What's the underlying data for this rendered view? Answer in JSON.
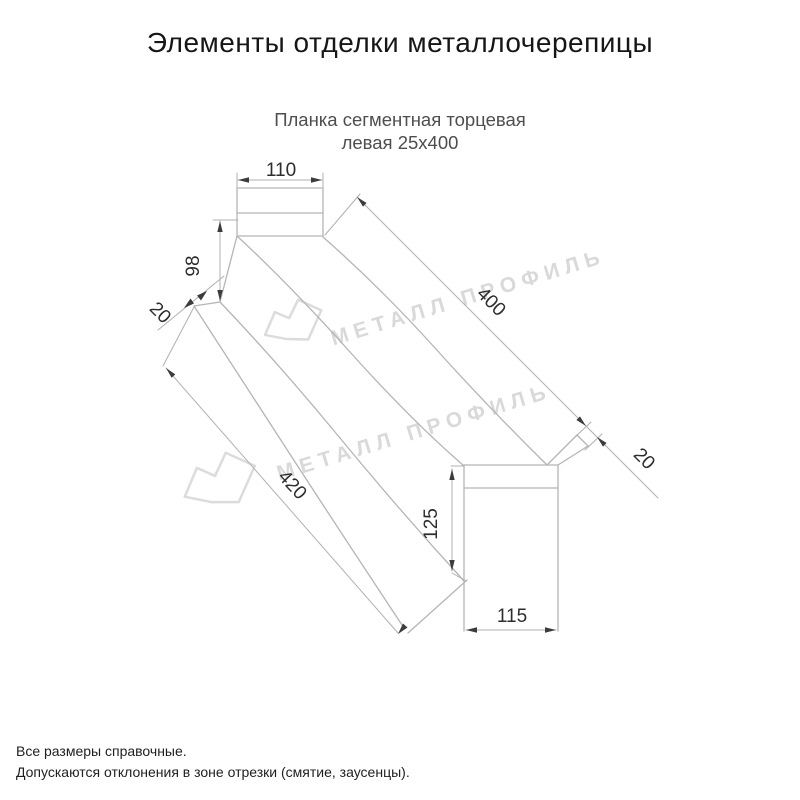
{
  "title": "Элементы отделки металлочерепицы",
  "subtitle": {
    "line1": "Планка сегментная торцевая",
    "line2": "левая 25х400"
  },
  "drawing": {
    "product": "Планка сегментная торцевая левая 25х400",
    "dims": {
      "top_width": "110",
      "far_end_height": "98",
      "left_end_fold": "20",
      "length_top": "400",
      "right_end_fold": "20",
      "length_bottom": "420",
      "end_height": "125",
      "end_width": "115"
    },
    "watermark_brand": "МЕТАЛЛ ПРОФИЛЬ",
    "colors": {
      "edge_line": "#b5b5b5",
      "dimension_text": "#2d2d2d",
      "arrow": "#3c3c3c",
      "watermark": "#d9d9d9",
      "title_text": "#161616",
      "subtitle_text": "#4e4e4e"
    }
  },
  "footer": {
    "line1": "Все размеры справочные.",
    "line2": "Допускаются отклонения в зоне отрезки (смятие, заусенцы)."
  }
}
